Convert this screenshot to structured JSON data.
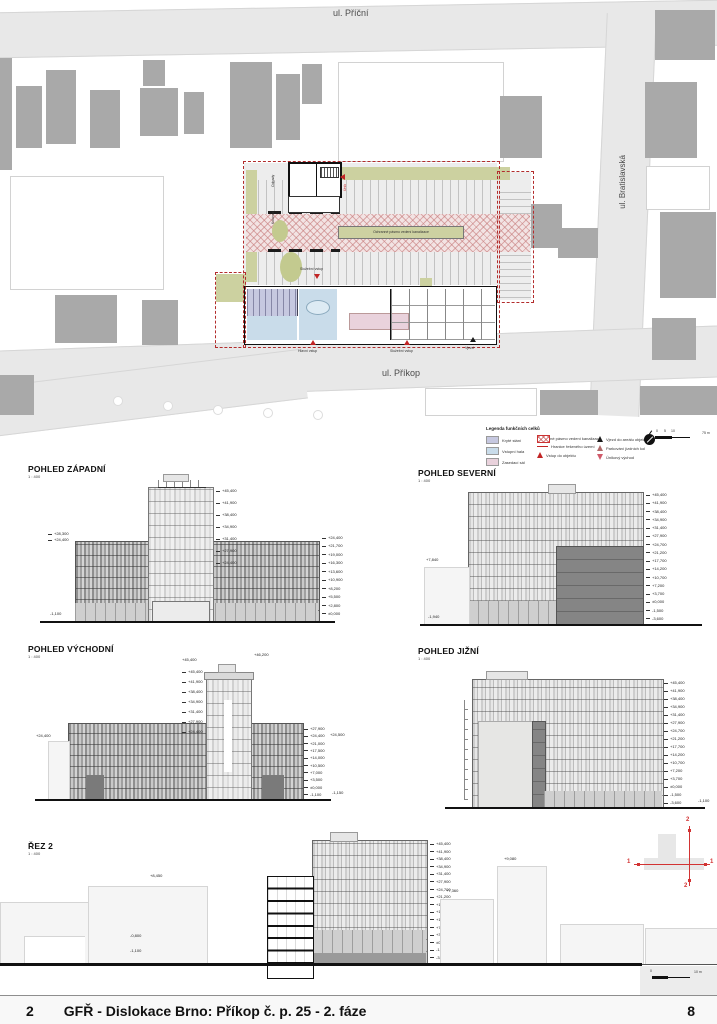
{
  "site_plan": {
    "streets": {
      "top": "ul. Příční",
      "right": "ul. Bratislavská",
      "bottom": "ul. Příkop"
    },
    "labels": {
      "odpady": "Odpady",
      "kolarna": "Kolárna",
      "unik": "Únik",
      "sluzebni_vstup_mid": "Služební vstup",
      "hlavni_vstup": "Hlavní vstup",
      "sluzebni_vstup": "Služební vstup",
      "vjezd": "Vjezd",
      "ochranne_pasmo": "Ochranné pásmo vedení kanalizace"
    }
  },
  "legend": {
    "title": "Legenda funkčních celků",
    "col1": [
      {
        "label": "Kryté stání",
        "color": "#c6c8e0"
      },
      {
        "label": "Vstupní hala",
        "color": "#c9dcea"
      },
      {
        "label": "Zasedací sál",
        "color": "#e9d2dc"
      }
    ],
    "col2": [
      {
        "label": "Ochranné pásmo vedení kanalizace",
        "type": "hatch"
      },
      {
        "label": "Hranice řešeného území",
        "type": "line"
      },
      {
        "label": "Vstup do objektu",
        "type": "tri-red"
      }
    ],
    "col3": [
      {
        "label": "Vjezd do areálu objektu",
        "type": "tri-black"
      },
      {
        "label": "Parkování jízdních kol",
        "type": "tri-gray"
      },
      {
        "label": "Únikový východ",
        "type": "tri-outline"
      }
    ],
    "scale": {
      "t0": "0",
      "t5": "5",
      "t10": "10",
      "right": "75 m"
    }
  },
  "elevations": {
    "west": {
      "title": "POHLED ZÁPADNÍ",
      "scale": "1 : 400",
      "tower_levels": [
        "+45,400",
        "+41,900",
        "+38,400",
        "+34,900",
        "+31,400",
        "+27,900",
        "+24,400"
      ],
      "left_levels": [
        "+28,300",
        "+24,400"
      ],
      "left_bottom": "-1,100",
      "right_levels": [
        "+24,400",
        "+21,700",
        "+19,000",
        "+16,300",
        "+13,600",
        "+10,900",
        "+8,200",
        "+5,500",
        "+2,800",
        "±0,000"
      ]
    },
    "north": {
      "title": "POHLED SEVERNÍ",
      "scale": "1 : 400",
      "left_top": "+7,840",
      "left_bottom": "-1,940",
      "right_levels": [
        "+45,400",
        "+41,900",
        "+38,400",
        "+34,900",
        "+31,400",
        "+27,900",
        "+24,700",
        "+21,200",
        "+17,700",
        "+14,200",
        "+10,700",
        "+7,200",
        "+3,700",
        "±0,000",
        "-1,500",
        "-3,600"
      ]
    },
    "east": {
      "title": "POHLED VÝCHODNÍ",
      "scale": "1 : 400",
      "top_left": "+45,400",
      "top_right": "+46,200",
      "left_label": "+24,400",
      "tower_levels": [
        "+45,400",
        "+41,900",
        "+38,400",
        "+34,900",
        "+31,400",
        "+27,900",
        "+24,400"
      ],
      "right_levels": [
        "+27,900",
        "+24,400",
        "+21,000",
        "+17,500",
        "+14,000",
        "+10,500",
        "+7,000",
        "+3,500",
        "±0,000",
        "-1,100"
      ],
      "right2_top": "+24,500",
      "right2_bottom": "-1,150"
    },
    "south": {
      "title": "POHLED JIŽNÍ",
      "scale": "1 : 400",
      "bottom_right": "-1,100",
      "right_levels": [
        "+45,400",
        "+41,900",
        "+38,400",
        "+34,900",
        "+31,400",
        "+27,900",
        "+24,700",
        "+21,200",
        "+17,700",
        "+14,200",
        "+10,700",
        "+7,200",
        "+3,700",
        "±0,000",
        "-1,500",
        "-3,600"
      ]
    }
  },
  "section": {
    "title": "ŘEZ 2",
    "scale": "1 : 400",
    "left_top": "+8,450",
    "left_mid": "-0,800",
    "left_bottom": "-1,100",
    "n1_label": "+7,360",
    "n2_label": "+9,080",
    "right_levels": [
      "+45,400",
      "+41,900",
      "+38,400",
      "+34,900",
      "+31,400",
      "+27,900",
      "+24,700",
      "+21,200",
      "+17,700",
      "+14,200",
      "+10,700",
      "+7,200",
      "+3,700",
      "±0,000",
      "-1,500",
      "-3,600"
    ],
    "keyplan": {
      "h1": "1",
      "h2": "1",
      "v1": "2",
      "v2": "2"
    },
    "scalebar": {
      "t0": "0",
      "right": "10 m"
    }
  },
  "footer": {
    "left": "2",
    "title": "GFŘ - Dislokace Brno: Příkop č. p. 25 - 2. fáze",
    "right": "8"
  }
}
